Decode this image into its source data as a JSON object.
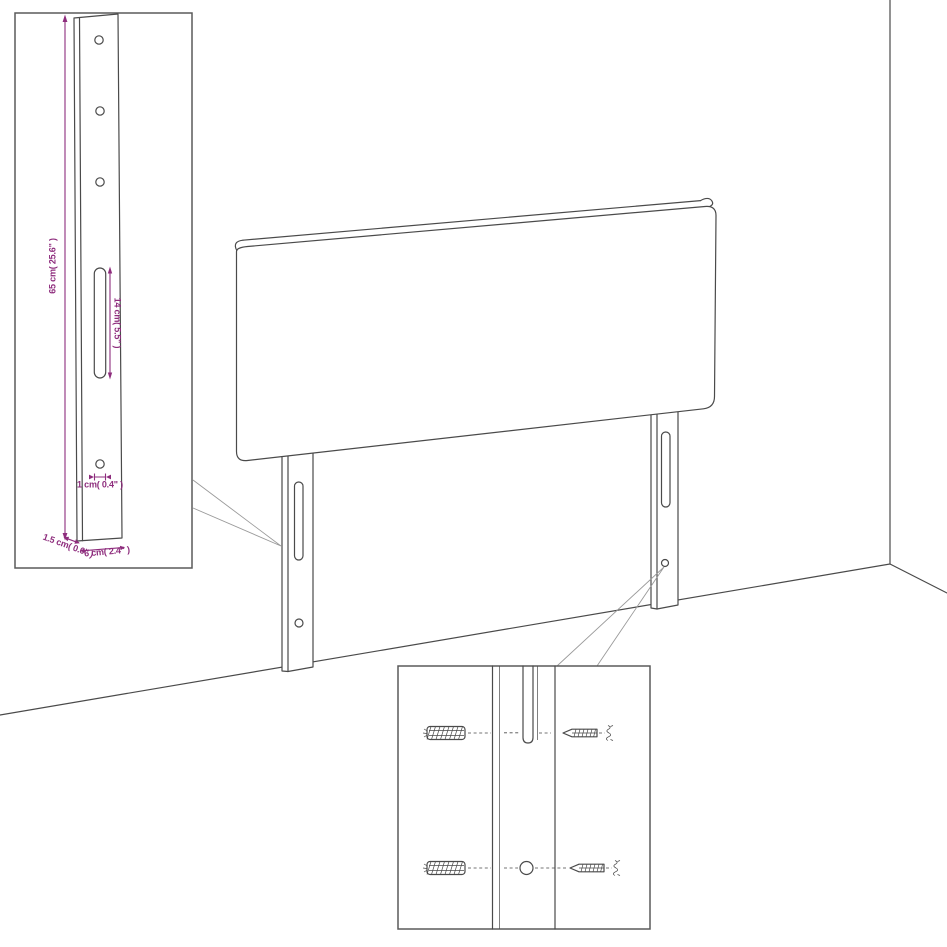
{
  "diagram": {
    "title_hint": "headboard assembly line drawing",
    "colors": {
      "line": "#4a4a4a",
      "dim": "#8e2d7d",
      "callout": "#9a9a9a",
      "inset": "#5a5a5a"
    },
    "insets": {
      "bracket_detail": {
        "labels": {
          "height": "65 cm( 25.6\" )",
          "slot_length": "14 cm( 5.5\" )",
          "hole_diameter": "1 cm( 0.4\" )",
          "thickness": "1.5 cm( 0.6\" )",
          "width": "6 cm( 2.4\" )"
        }
      },
      "mounting_detail": {
        "parts": [
          "wall-plug",
          "screw",
          "leg-slot",
          "leg-hole"
        ]
      }
    }
  }
}
